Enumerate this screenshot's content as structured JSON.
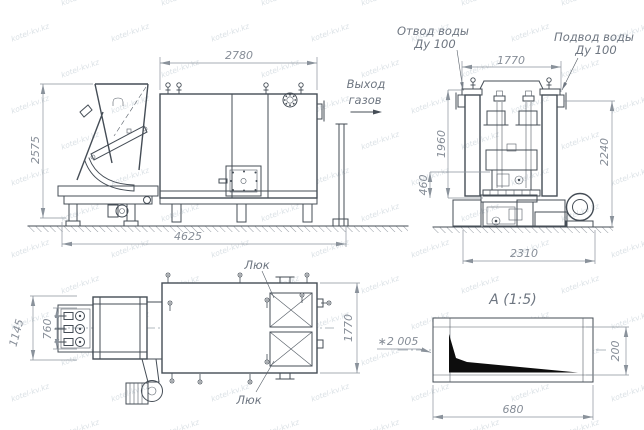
{
  "watermark": {
    "text": "kotel-kv.kz"
  },
  "colors": {
    "line": "#454d56",
    "dim_text": "#868d97",
    "label_text": "#6e7681",
    "wedge_fill": "#0d0d0d",
    "background": "#ffffff"
  },
  "side_view": {
    "dim_width_top": "2780",
    "dim_height_left": "2575",
    "dim_length_bottom": "4625",
    "gas_outlet_line1": "Выход",
    "gas_outlet_line2": "газов"
  },
  "front_view": {
    "water_outlet_line1": "Отвод воды",
    "water_outlet_line2": "Ду 100",
    "water_inlet_line1": "Подвод воды",
    "water_inlet_line2": "Ду 100",
    "dim_width_top": "1770",
    "dim_height_mid": "1960",
    "dim_height_low": "460",
    "dim_height_right": "2240",
    "dim_width_bottom": "2310"
  },
  "plan_view": {
    "hatch_top_label": "Люк",
    "hatch_bottom_label": "Люк",
    "dim_height_outer": "1145",
    "dim_height_inner": "760",
    "dim_height_right": "1770"
  },
  "detail_view": {
    "title": "А (1:5)",
    "leader_dim": "∗2 005",
    "dim_width": "680",
    "dim_height": "200"
  }
}
